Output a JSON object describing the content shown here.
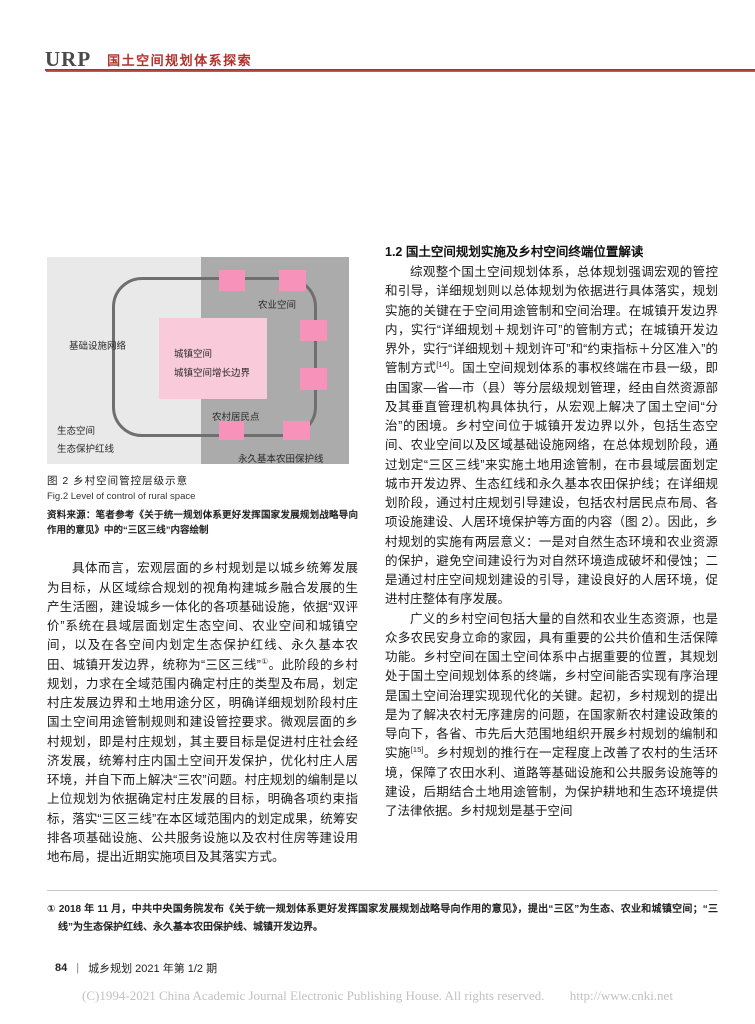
{
  "header": {
    "logo": "URP",
    "section_title": "国土空间规划体系探索",
    "accent_color": "#b2332c"
  },
  "figure": {
    "labels": {
      "agricultural_space": "农业空间",
      "infrastructure_network": "基础设施网络",
      "urban_space": "城镇空间",
      "urban_growth_boundary": "城镇空间增长边界",
      "rural_settlement": "农村居民点",
      "ecological_space": "生态空间",
      "ecological_redline": "生态保护红线",
      "permanent_farmland_line": "永久基本农田保护线"
    },
    "caption_zh": "图 2  乡村空间管控层级示意",
    "caption_en": "Fig.2   Level of control of rural space",
    "source_note": "资料来源：笔者参考《关于统一规划体系更好发挥国家发展规划战略导向作用的意见》中的“三区三线”内容绘制",
    "colors": {
      "left_background": "#e9e9e9",
      "right_background": "#ababab",
      "boundary_line": "#6f6f6f",
      "square_pink": "#f792bb",
      "center_box_pink": "#f9cbda"
    }
  },
  "left_column": {
    "paragraph": [
      {
        "t": "具体而言，宏观层面的乡村规划是以城乡统筹发展为目标，从区域综合规划的视角构建城乡融合发展的生产生活圈，建设城乡一体化的各项基础设施，依据“双评价”系统在县域层面划定生态空间、农业空间和城镇空间，以及在各空间内划定生态保护红线、永久基本农田、城镇开发边界，统称为“三区三线”",
        "sup": false
      },
      {
        "t": "①",
        "sup": true
      },
      {
        "t": "。此阶段的乡村规划，力求在全域范围内确定村庄的类型及布局，划定村庄发展边界和土地用途分区，明确详细规划阶段村庄国土空间用途管制规则和建设管控要求。微观层面的乡村规划，即是村庄规划，其主要目标是促进村庄社会经济发展，统筹村庄内国土空间开发保护，优化村庄人居环境，并自下而上解决“三农”问题。村庄规划的编制是以上位规划为依据确定村庄发展的目标，明确各项约束指标，落实“三区三线”在本区域范围内的划定成果，统筹安排各项基础设施、公共服务设施以及农村住房等建设用地布局，提出近期实施项目及其落实方式。",
        "sup": false
      }
    ]
  },
  "right_column": {
    "heading": "1.2  国土空间规划实施及乡村空间终端位置解读",
    "para1": [
      {
        "t": "综观整个国土空间规划体系，总体规划强调宏观的管控和引导，详细规划则以总体规划为依据进行具体落实，规划实施的关键在于空间用途管制和空间治理。在城镇开发边界内，实行“详细规划＋规划许可”的管制方式；在城镇开发边界外，实行“详细规划＋规划许可”和“约束指标＋分区准入”的管制方式",
        "sup": false
      },
      {
        "t": "[14]",
        "sup": true
      },
      {
        "t": "。国土空间规划体系的事权终端在市县一级，即由国家—省—市（县）等分层级规划管理，经由自然资源部及其垂直管理机构具体执行，从宏观上解决了国土空间“分治”的困境。乡村空间位于城镇开发边界以外，包括生态空间、农业空间以及区域基础设施网络，在总体规划阶段，通过划定“三区三线”来实施土地用途管制，在市县域层面划定城市开发边界、生态红线和永久基本农田保护线；在详细规划阶段，通过村庄规划引导建设，包括农村居民点布局、各项设施建设、人居环境保护等方面的内容（图 2）。因此，乡村规划的实施有两层意义：一是对自然生态环境和农业资源的保护，避免空间建设行为对自然环境造成破坏和侵蚀；二是通过村庄空间规划建设的引导，建设良好的人居环境，促进村庄整体有序发展。",
        "sup": false
      }
    ],
    "para2": [
      {
        "t": "广义的乡村空间包括大量的自然和农业生态资源，也是众多农民安身立命的家园，具有重要的公共价值和生活保障功能。乡村空间在国土空间体系中占据重要的位置，其规划处于国土空间规划体系的终端，乡村空间能否实现有序治理是国土空间治理实现现代化的关键。起初，乡村规划的提出是为了解决农村无序建房的问题，在国家新农村建设政策的导向下，各省、市先后大范围地组织开展乡村规划的编制和实施",
        "sup": false
      },
      {
        "t": "[15]",
        "sup": true
      },
      {
        "t": "。乡村规划的推行在一定程度上改善了农村的生活环境，保障了农田水利、道路等基础设施和公共服务设施等的建设，后期结合土地用途管制，为保护耕地和生态环境提供了法律依据。乡村规划是基于空间",
        "sup": false
      }
    ]
  },
  "footnote": {
    "text": "①  2018 年 11 月，中共中央国务院发布《关于统一规划体系更好发挥国家发展规划战略导向作用的意见》，提出“三区”为生态、农业和城镇空间；“三线”为生态保护红线、永久基本农田保护线、城镇开发边界。"
  },
  "footer": {
    "page_number": "84",
    "separator": "|",
    "journal": "城乡规划 2021 年第 1/2 期"
  },
  "copyright": {
    "text": "(C)1994-2021 China Academic Journal Electronic Publishing House. All rights reserved.",
    "url": "http://www.cnki.net"
  }
}
